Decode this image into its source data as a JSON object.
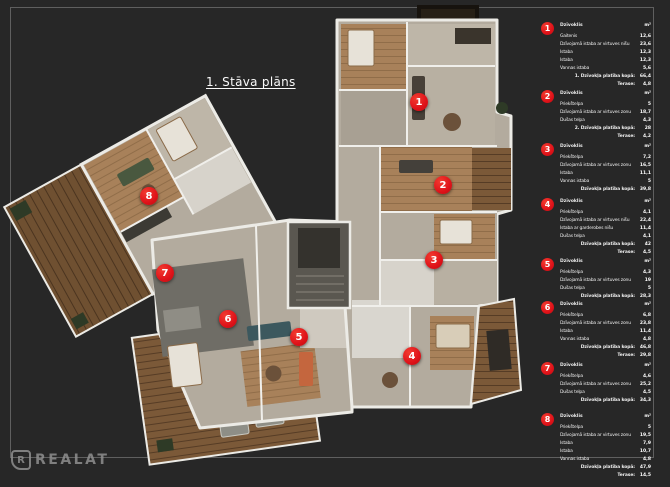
{
  "title": {
    "text": "1. Stāva plāns"
  },
  "watermark": {
    "icon_letter": "R",
    "text": "REALAT"
  },
  "colors": {
    "background": "#272727",
    "marker_red": "#df1219",
    "text": "#f2f2f2",
    "frame": "#6a6a6a"
  },
  "plan": {
    "marker_numbers": [
      "1",
      "2",
      "3",
      "4",
      "5",
      "6",
      "7",
      "8"
    ]
  },
  "legend": {
    "unit": "m²",
    "entries": [
      {
        "number": "1",
        "header": "Dzīvoklis",
        "rows": [
          {
            "label": "Gaitenis",
            "value": "12,6"
          },
          {
            "label": "Dzīvojamā istaba ar virtuves nišu",
            "value": "23,6"
          },
          {
            "label": "Istaba",
            "value": "12,3"
          },
          {
            "label": "Istaba",
            "value": "12,3"
          },
          {
            "label": "Vannas istaba",
            "value": "5,6"
          }
        ],
        "total_label": "1. Dzīvokļa platība kopā:",
        "total_value": "66,4",
        "terrace_label": "Terase:",
        "terrace_value": "4,8"
      },
      {
        "number": "2",
        "header": "Dzīvoklis",
        "rows": [
          {
            "label": "Priekštelpa",
            "value": "5"
          },
          {
            "label": "Dzīvojamā istaba ar virtuves zonu",
            "value": "18,7"
          },
          {
            "label": "Dušas telpa",
            "value": "4,3"
          }
        ],
        "total_label": "2. Dzīvokļa platība kopā:",
        "total_value": "28",
        "terrace_label": "Terase:",
        "terrace_value": "4,2"
      },
      {
        "number": "3",
        "header": "Dzīvoklis",
        "rows": [
          {
            "label": "Priekštelpa",
            "value": "7,2"
          },
          {
            "label": "Dzīvojamā istaba ar virtuves zonu",
            "value": "16,5"
          },
          {
            "label": "Istaba",
            "value": "11,1"
          },
          {
            "label": "Vannas istaba",
            "value": "5"
          }
        ],
        "total_label": "Dzīvokļa platība kopā:",
        "total_value": "39,8",
        "terrace_label": "",
        "terrace_value": ""
      },
      {
        "number": "4",
        "header": "Dzīvoklis",
        "rows": [
          {
            "label": "Priekštelpa",
            "value": "4,1"
          },
          {
            "label": "Dzīvojamā istaba ar virtuves nišu",
            "value": "22,4"
          },
          {
            "label": "Istaba ar garderobes nišu",
            "value": "11,4"
          },
          {
            "label": "Dušas telpa",
            "value": "4,1"
          }
        ],
        "total_label": "Dzīvokļa platība kopā:",
        "total_value": "42",
        "terrace_label": "Terase:",
        "terrace_value": "4,5"
      },
      {
        "number": "5",
        "header": "Dzīvoklis",
        "rows": [
          {
            "label": "Priekštelpa",
            "value": "4,3"
          },
          {
            "label": "Dzīvojamā istaba ar virtuves zonu",
            "value": "19"
          },
          {
            "label": "Dušas telpa",
            "value": "5"
          }
        ],
        "total_label": "Dzīvokļa platība kopā:",
        "total_value": "28,3",
        "terrace_label": "",
        "terrace_value": ""
      },
      {
        "number": "6",
        "header": "Dzīvoklis",
        "rows": [
          {
            "label": "Priekštelpa",
            "value": "6,8"
          },
          {
            "label": "Dzīvojamā istaba ar virtuves zonu",
            "value": "23,8"
          },
          {
            "label": "Istaba",
            "value": "11,4"
          },
          {
            "label": "Vannas istaba",
            "value": "4,8"
          }
        ],
        "total_label": "Dzīvokļa platība kopā:",
        "total_value": "46,8",
        "terrace_label": "Terase:",
        "terrace_value": "29,8"
      },
      {
        "number": "7",
        "header": "Dzīvoklis",
        "rows": [
          {
            "label": "Priekštelpa",
            "value": "4,6"
          },
          {
            "label": "Dzīvojamā istaba ar virtuves zonu",
            "value": "25,2"
          },
          {
            "label": "Dušas telpa",
            "value": "4,5"
          }
        ],
        "total_label": "Dzīvokļa platība kopā:",
        "total_value": "34,3",
        "terrace_label": "",
        "terrace_value": ""
      },
      {
        "number": "8",
        "header": "Dzīvoklis",
        "rows": [
          {
            "label": "Priekštelpa",
            "value": "5"
          },
          {
            "label": "Dzīvojamā istaba ar virtuves zonu",
            "value": "19,5"
          },
          {
            "label": "Istaba",
            "value": "7,9"
          },
          {
            "label": "Istaba",
            "value": "10,7"
          },
          {
            "label": "Vannas istaba",
            "value": "4,8"
          }
        ],
        "total_label": "Dzīvokļa platība kopā:",
        "total_value": "47,9",
        "terrace_label": "Terase:",
        "terrace_value": "14,5"
      }
    ]
  }
}
